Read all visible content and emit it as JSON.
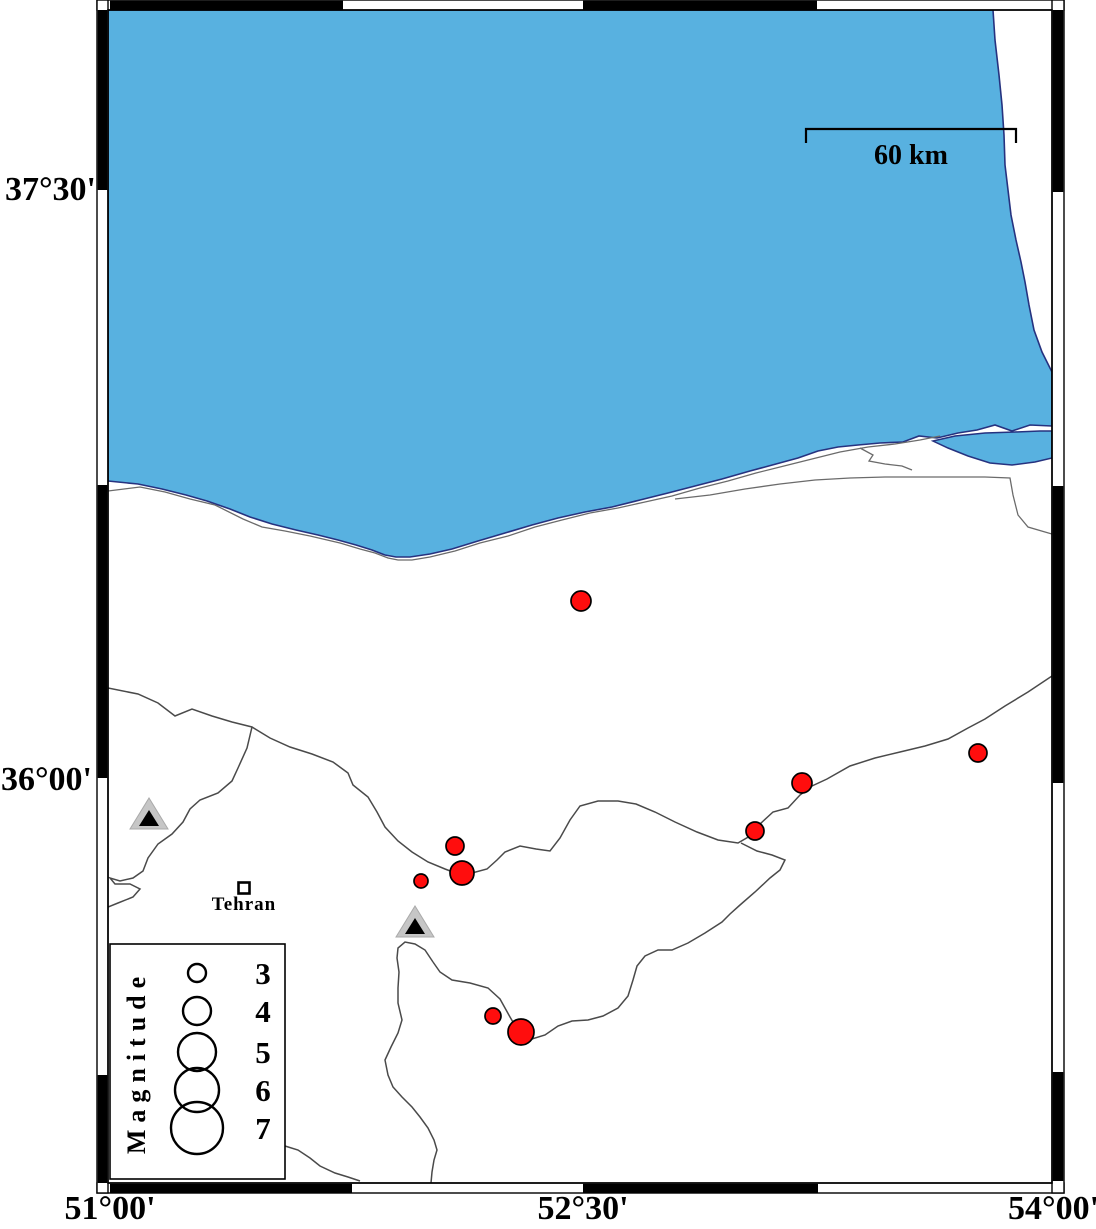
{
  "map": {
    "title_hint": "seismicity-map",
    "axis": {
      "lat_labels": [
        {
          "text": "37°30'"
        },
        {
          "text": "36°00'"
        }
      ],
      "lon_labels": [
        {
          "text": "51°00'"
        },
        {
          "text": "52°30'"
        },
        {
          "text": "54°00'"
        }
      ]
    },
    "scale_bar": {
      "label": "60 km"
    },
    "city": {
      "name": "Tehran",
      "x": 244,
      "y": 888
    },
    "volcanoes": [
      {
        "x": 149,
        "y": 813
      },
      {
        "x": 415,
        "y": 921
      }
    ],
    "earthquakes": [
      {
        "x": 581,
        "y": 601,
        "r": 10
      },
      {
        "x": 455,
        "y": 846,
        "r": 9
      },
      {
        "x": 462,
        "y": 873,
        "r": 12
      },
      {
        "x": 421,
        "y": 881,
        "r": 7
      },
      {
        "x": 755,
        "y": 831,
        "r": 9
      },
      {
        "x": 802,
        "y": 783,
        "r": 10
      },
      {
        "x": 978,
        "y": 753,
        "r": 9
      },
      {
        "x": 493,
        "y": 1016,
        "r": 8
      },
      {
        "x": 521,
        "y": 1032,
        "r": 13
      }
    ],
    "legend": {
      "title": "Magnitude",
      "cx": 197,
      "entries": [
        {
          "label": "3",
          "r": 9,
          "cy": 973
        },
        {
          "label": "4",
          "r": 14,
          "cy": 1011
        },
        {
          "label": "5",
          "r": 19,
          "cy": 1052
        },
        {
          "label": "6",
          "r": 22,
          "cy": 1090
        },
        {
          "label": "7",
          "r": 26,
          "cy": 1128
        }
      ]
    },
    "colors": {
      "sea": "#58B1E0",
      "coast_stroke": "#26327F",
      "boundary_line": "#4a4a4a",
      "secondary_line": "#6b6b6b",
      "earthquake": "#FF0D0D",
      "volcano_fill": "#C6C6C6",
      "volcano_core": "#000000",
      "frame": "#000000"
    }
  }
}
